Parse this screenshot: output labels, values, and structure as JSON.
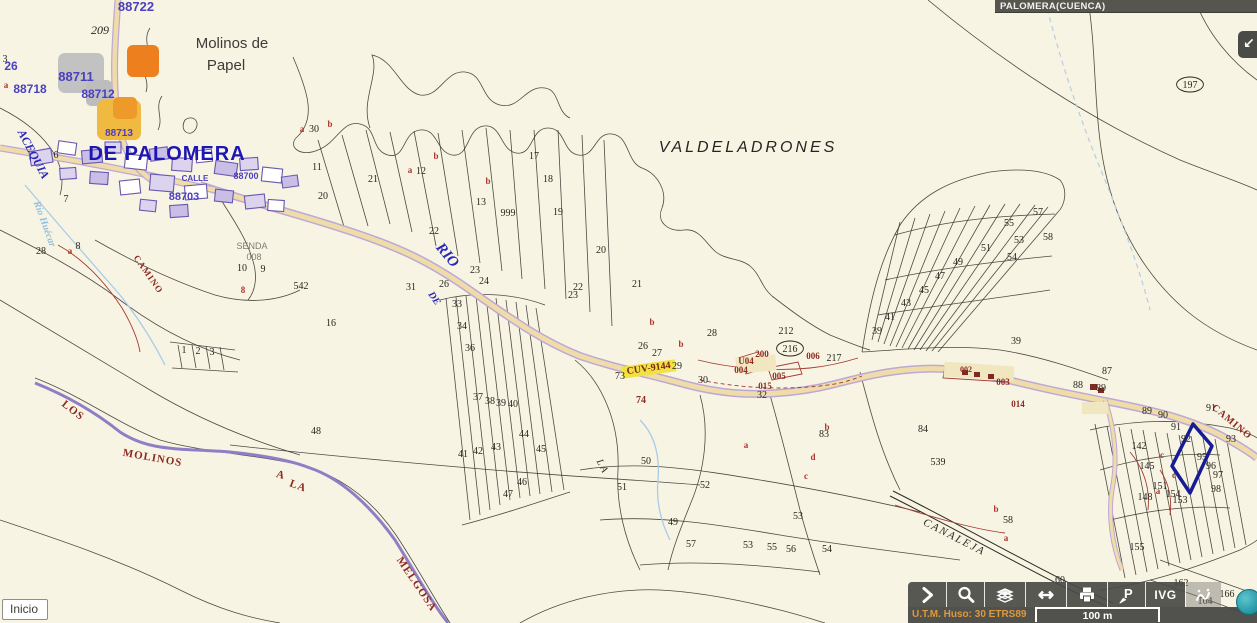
{
  "header": {
    "title": "PALOMERA(CUENCA)"
  },
  "controls": {
    "inicio_label": "Inicio",
    "expand_icon": "collapse-arrow-icon"
  },
  "toolbar": {
    "ivg_label": "IVG",
    "buttons": [
      {
        "id": "expand-tools",
        "icon": "chevron-right-icon"
      },
      {
        "id": "zoom-search",
        "icon": "magnifier-icon"
      },
      {
        "id": "layers",
        "icon": "layers-icon"
      },
      {
        "id": "measure",
        "icon": "double-arrow-icon"
      },
      {
        "id": "print",
        "icon": "printer-icon"
      },
      {
        "id": "point-query",
        "icon": "point-p-icon"
      },
      {
        "id": "ivg",
        "icon": "text-IVG"
      },
      {
        "id": "sketch",
        "icon": "sketch-icon"
      },
      {
        "id": "info",
        "icon": "info-circle-icon"
      }
    ]
  },
  "statusbar": {
    "utm_text": "U.T.M. Huso: 30 ETRS89",
    "scale_label": "100 m"
  },
  "map": {
    "colors": {
      "background": "#F8F4E3",
      "parcel_line": "#3A3831",
      "boundary_purple": "#8F7EC6",
      "road_fill": "#F0DCA8",
      "road_casing": "#BCA9D6",
      "highlight_navy": "#151C96",
      "toolbar_bg": "#4A4A46",
      "utm_orange": "#DE9A3A",
      "header_bg": "#56564E",
      "marker_orange": "#EE7F1F",
      "marker_amber": "#F0B93F",
      "marker_gray": "#C2C2C2",
      "cuv_yellow": "#EFE13A",
      "stream_blue": "#A8CCE8",
      "red_line": "#A43A32"
    },
    "labels": [
      {
        "t": "Molinos de",
        "x": 232,
        "y": 48,
        "k": "place",
        "s": 15
      },
      {
        "t": "Papel",
        "x": 226,
        "y": 70,
        "k": "place",
        "s": 15
      },
      {
        "t": "VALDELADRONES",
        "x": 748,
        "y": 152,
        "k": "valde",
        "s": 16
      },
      {
        "t": "DE PALOMERA",
        "x": 167,
        "y": 160,
        "k": "bluebig",
        "s": 20
      },
      {
        "t": "ACEQUIA",
        "x": 30,
        "y": 156,
        "k": "blueital",
        "s": 12,
        "r": 62
      },
      {
        "t": "Río Huécar",
        "x": 42,
        "y": 225,
        "k": "stream",
        "s": 10,
        "r": 70
      },
      {
        "t": "RIO",
        "x": 444,
        "y": 258,
        "k": "blueital",
        "s": 15,
        "r": 50
      },
      {
        "t": "DE",
        "x": 432,
        "y": 300,
        "k": "blueital",
        "s": 10,
        "r": 55
      },
      {
        "t": "SENDA",
        "x": 252,
        "y": 249,
        "k": "gray",
        "s": 9
      },
      {
        "t": "008",
        "x": 254,
        "y": 260,
        "k": "gray",
        "s": 9
      },
      {
        "t": "LOS",
        "x": 71,
        "y": 413,
        "k": "road",
        "s": 11,
        "r": 38
      },
      {
        "t": "MOLINOS",
        "x": 152,
        "y": 461,
        "k": "road",
        "s": 11,
        "r": 10
      },
      {
        "t": "A",
        "x": 280,
        "y": 478,
        "k": "road",
        "s": 11,
        "r": 15
      },
      {
        "t": "LA",
        "x": 297,
        "y": 489,
        "k": "road",
        "s": 11,
        "r": 20
      },
      {
        "t": "MELGOSA",
        "x": 414,
        "y": 586,
        "k": "road",
        "s": 11,
        "r": 56
      },
      {
        "t": "CANALEJA",
        "x": 953,
        "y": 540,
        "k": "canal",
        "s": 11,
        "r": 27
      },
      {
        "t": "CAMINO",
        "x": 1230,
        "y": 424,
        "k": "road",
        "s": 10,
        "r": 40
      },
      {
        "t": "CAMINO",
        "x": 146,
        "y": 276,
        "k": "road",
        "s": 9,
        "r": 55
      },
      {
        "t": "CUV-9144",
        "x": 649,
        "y": 371,
        "k": "cuv",
        "s": 10,
        "r": -8
      },
      {
        "t": "LA",
        "x": 600,
        "y": 468,
        "k": "canal",
        "s": 10,
        "r": 62
      },
      {
        "t": "88722",
        "x": 136,
        "y": 11,
        "k": "village",
        "s": 13
      },
      {
        "t": "26",
        "x": 11,
        "y": 70,
        "k": "village",
        "s": 12
      },
      {
        "t": "88711",
        "x": 76,
        "y": 81,
        "k": "village",
        "s": 13
      },
      {
        "t": "88718",
        "x": 30,
        "y": 93,
        "k": "village",
        "s": 12
      },
      {
        "t": "88712",
        "x": 98,
        "y": 98,
        "k": "village",
        "s": 12
      },
      {
        "t": "88713",
        "x": 119,
        "y": 136,
        "k": "village",
        "s": 10
      },
      {
        "t": "88703",
        "x": 184,
        "y": 200,
        "k": "village",
        "s": 11
      },
      {
        "t": "CALLE",
        "x": 195,
        "y": 181,
        "k": "village",
        "s": 8
      },
      {
        "t": "88700",
        "x": 246,
        "y": 179,
        "k": "village",
        "s": 9
      },
      {
        "t": "3",
        "x": 5,
        "y": 62,
        "k": "num"
      },
      {
        "t": "a",
        "x": 6,
        "y": 88,
        "k": "red"
      },
      {
        "t": "209",
        "x": 100,
        "y": 34,
        "k": "numi",
        "s": 12
      },
      {
        "t": "216",
        "x": 790,
        "y": 352,
        "k": "num",
        "s": 10,
        "oval": 1
      },
      {
        "t": "197",
        "x": 1190,
        "y": 88,
        "k": "num",
        "s": 10,
        "oval": 1
      },
      {
        "t": "212",
        "x": 786,
        "y": 334,
        "k": "num",
        "s": 9
      },
      {
        "t": "200",
        "x": 762,
        "y": 357,
        "k": "code",
        "s": 9
      },
      {
        "t": "U04",
        "x": 746,
        "y": 364,
        "k": "code",
        "s": 9
      },
      {
        "t": "004",
        "x": 741,
        "y": 373,
        "k": "code",
        "s": 9
      },
      {
        "t": "005",
        "x": 779,
        "y": 379,
        "k": "code",
        "s": 9
      },
      {
        "t": "015",
        "x": 765,
        "y": 389,
        "k": "code",
        "s": 9
      },
      {
        "t": "006",
        "x": 813,
        "y": 359,
        "k": "code",
        "s": 9
      },
      {
        "t": "217",
        "x": 834,
        "y": 361,
        "k": "num",
        "s": 10
      },
      {
        "t": "003",
        "x": 1003,
        "y": 385,
        "k": "code",
        "s": 9
      },
      {
        "t": "014",
        "x": 1018,
        "y": 407,
        "k": "code",
        "s": 9
      },
      {
        "t": "002",
        "x": 966,
        "y": 372,
        "k": "code",
        "s": 8
      },
      {
        "t": "74",
        "x": 641,
        "y": 403,
        "k": "code",
        "s": 10
      },
      {
        "t": "b",
        "x": 330,
        "y": 127,
        "k": "red"
      },
      {
        "t": "b",
        "x": 436,
        "y": 159,
        "k": "red"
      },
      {
        "t": "b",
        "x": 488,
        "y": 184,
        "k": "red"
      },
      {
        "t": "a",
        "x": 410,
        "y": 173,
        "k": "red"
      },
      {
        "t": "a",
        "x": 302,
        "y": 132,
        "k": "red"
      },
      {
        "t": "b",
        "x": 652,
        "y": 325,
        "k": "red"
      },
      {
        "t": "b",
        "x": 681,
        "y": 347,
        "k": "red"
      },
      {
        "t": "a",
        "x": 746,
        "y": 448,
        "k": "red"
      },
      {
        "t": "d",
        "x": 813,
        "y": 460,
        "k": "red"
      },
      {
        "t": "c",
        "x": 806,
        "y": 479,
        "k": "red"
      },
      {
        "t": "b",
        "x": 827,
        "y": 430,
        "k": "red"
      },
      {
        "t": "a",
        "x": 1006,
        "y": 541,
        "k": "red"
      },
      {
        "t": "b",
        "x": 996,
        "y": 512,
        "k": "red"
      },
      {
        "t": "c",
        "x": 1162,
        "y": 458,
        "k": "red"
      },
      {
        "t": "c",
        "x": 1174,
        "y": 478,
        "k": "red"
      },
      {
        "t": "a",
        "x": 1158,
        "y": 494,
        "k": "red"
      },
      {
        "t": "a",
        "x": 70,
        "y": 254,
        "k": "red"
      },
      {
        "t": "8",
        "x": 243,
        "y": 293,
        "k": "red"
      },
      {
        "t": "30",
        "x": 314,
        "y": 132,
        "k": "num"
      },
      {
        "t": "11",
        "x": 317,
        "y": 170,
        "k": "num"
      },
      {
        "t": "20",
        "x": 323,
        "y": 199,
        "k": "num"
      },
      {
        "t": "21",
        "x": 373,
        "y": 182,
        "k": "num"
      },
      {
        "t": "12",
        "x": 421,
        "y": 174,
        "k": "num"
      },
      {
        "t": "13",
        "x": 481,
        "y": 205,
        "k": "num"
      },
      {
        "t": "999",
        "x": 508,
        "y": 216,
        "k": "num"
      },
      {
        "t": "17",
        "x": 534,
        "y": 159,
        "k": "num"
      },
      {
        "t": "18",
        "x": 548,
        "y": 182,
        "k": "num"
      },
      {
        "t": "19",
        "x": 558,
        "y": 215,
        "k": "num"
      },
      {
        "t": "20",
        "x": 601,
        "y": 253,
        "k": "num"
      },
      {
        "t": "21",
        "x": 637,
        "y": 287,
        "k": "num"
      },
      {
        "t": "22",
        "x": 434,
        "y": 234,
        "k": "num",
        "s": 9
      },
      {
        "t": "22",
        "x": 578,
        "y": 290,
        "k": "num",
        "s": 9
      },
      {
        "t": "23",
        "x": 573,
        "y": 298,
        "k": "num",
        "s": 9
      },
      {
        "t": "23",
        "x": 475,
        "y": 273,
        "k": "num",
        "s": 9
      },
      {
        "t": "24",
        "x": 484,
        "y": 284,
        "k": "num",
        "s": 9
      },
      {
        "t": "26",
        "x": 444,
        "y": 287,
        "k": "num",
        "s": 9
      },
      {
        "t": "31",
        "x": 411,
        "y": 290,
        "k": "num"
      },
      {
        "t": "28",
        "x": 712,
        "y": 336,
        "k": "num"
      },
      {
        "t": "6",
        "x": 56,
        "y": 158,
        "k": "num",
        "s": 8
      },
      {
        "t": "7",
        "x": 66,
        "y": 202,
        "k": "num"
      },
      {
        "t": "8",
        "x": 78,
        "y": 249,
        "k": "num"
      },
      {
        "t": "28",
        "x": 41,
        "y": 254,
        "k": "num"
      },
      {
        "t": "10",
        "x": 242,
        "y": 271,
        "k": "num"
      },
      {
        "t": "9",
        "x": 263,
        "y": 272,
        "k": "num"
      },
      {
        "t": "542",
        "x": 301,
        "y": 289,
        "k": "num"
      },
      {
        "t": "16",
        "x": 331,
        "y": 326,
        "k": "num"
      },
      {
        "t": "1",
        "x": 184,
        "y": 353,
        "k": "num",
        "s": 8
      },
      {
        "t": "2",
        "x": 198,
        "y": 354,
        "k": "num",
        "s": 8
      },
      {
        "t": "3",
        "x": 212,
        "y": 355,
        "k": "num",
        "s": 8
      },
      {
        "t": "33",
        "x": 457,
        "y": 307,
        "k": "num"
      },
      {
        "t": "34",
        "x": 462,
        "y": 329,
        "k": "num"
      },
      {
        "t": "36",
        "x": 470,
        "y": 351,
        "k": "num"
      },
      {
        "t": "37",
        "x": 478,
        "y": 400,
        "k": "num",
        "s": 8
      },
      {
        "t": "38",
        "x": 490,
        "y": 404,
        "k": "num",
        "s": 8
      },
      {
        "t": "39",
        "x": 501,
        "y": 406,
        "k": "num",
        "s": 8
      },
      {
        "t": "40",
        "x": 513,
        "y": 407,
        "k": "num",
        "s": 8
      },
      {
        "t": "41",
        "x": 463,
        "y": 457,
        "k": "num"
      },
      {
        "t": "42",
        "x": 478,
        "y": 454,
        "k": "num"
      },
      {
        "t": "43",
        "x": 496,
        "y": 450,
        "k": "num"
      },
      {
        "t": "44",
        "x": 524,
        "y": 437,
        "k": "num"
      },
      {
        "t": "45",
        "x": 541,
        "y": 452,
        "k": "num"
      },
      {
        "t": "46",
        "x": 522,
        "y": 485,
        "k": "num"
      },
      {
        "t": "47",
        "x": 508,
        "y": 497,
        "k": "num"
      },
      {
        "t": "48",
        "x": 316,
        "y": 434,
        "k": "num",
        "s": 11
      },
      {
        "t": "26",
        "x": 643,
        "y": 349,
        "k": "num",
        "s": 9
      },
      {
        "t": "27",
        "x": 657,
        "y": 356,
        "k": "num",
        "s": 9
      },
      {
        "t": "29",
        "x": 677,
        "y": 369,
        "k": "num"
      },
      {
        "t": "73",
        "x": 620,
        "y": 379,
        "k": "num"
      },
      {
        "t": "30",
        "x": 703,
        "y": 383,
        "k": "num"
      },
      {
        "t": "32",
        "x": 762,
        "y": 398,
        "k": "num"
      },
      {
        "t": "39",
        "x": 1016,
        "y": 344,
        "k": "num"
      },
      {
        "t": "50",
        "x": 646,
        "y": 464,
        "k": "num"
      },
      {
        "t": "51",
        "x": 622,
        "y": 490,
        "k": "num"
      },
      {
        "t": "52",
        "x": 705,
        "y": 488,
        "k": "num"
      },
      {
        "t": "49",
        "x": 673,
        "y": 525,
        "k": "num"
      },
      {
        "t": "57",
        "x": 691,
        "y": 547,
        "k": "num"
      },
      {
        "t": "53",
        "x": 748,
        "y": 548,
        "k": "num"
      },
      {
        "t": "55",
        "x": 772,
        "y": 550,
        "k": "num"
      },
      {
        "t": "56",
        "x": 791,
        "y": 552,
        "k": "num"
      },
      {
        "t": "53",
        "x": 798,
        "y": 519,
        "k": "num"
      },
      {
        "t": "54",
        "x": 827,
        "y": 552,
        "k": "num"
      },
      {
        "t": "58",
        "x": 1008,
        "y": 523,
        "k": "num"
      },
      {
        "t": "60",
        "x": 1060,
        "y": 583,
        "k": "num"
      },
      {
        "t": "83",
        "x": 824,
        "y": 437,
        "k": "num"
      },
      {
        "t": "84",
        "x": 923,
        "y": 432,
        "k": "num"
      },
      {
        "t": "539",
        "x": 938,
        "y": 465,
        "k": "num"
      },
      {
        "t": "87",
        "x": 1107,
        "y": 374,
        "k": "num"
      },
      {
        "t": "88",
        "x": 1078,
        "y": 388,
        "k": "num"
      },
      {
        "t": "89",
        "x": 1101,
        "y": 391,
        "k": "num"
      },
      {
        "t": "89",
        "x": 1147,
        "y": 414,
        "k": "num",
        "s": 8
      },
      {
        "t": "90",
        "x": 1163,
        "y": 418,
        "k": "num",
        "s": 8
      },
      {
        "t": "91",
        "x": 1211,
        "y": 411,
        "k": "num"
      },
      {
        "t": "91",
        "x": 1176,
        "y": 430,
        "k": "num"
      },
      {
        "t": "92",
        "x": 1186,
        "y": 442,
        "k": "num"
      },
      {
        "t": "93",
        "x": 1231,
        "y": 442,
        "k": "num"
      },
      {
        "t": "95",
        "x": 1202,
        "y": 460,
        "k": "num"
      },
      {
        "t": "96",
        "x": 1211,
        "y": 469,
        "k": "num"
      },
      {
        "t": "97",
        "x": 1218,
        "y": 478,
        "k": "num"
      },
      {
        "t": "98",
        "x": 1216,
        "y": 492,
        "k": "num"
      },
      {
        "t": "142",
        "x": 1139,
        "y": 449,
        "k": "num"
      },
      {
        "t": "145",
        "x": 1147,
        "y": 469,
        "k": "num"
      },
      {
        "t": "148",
        "x": 1145,
        "y": 500,
        "k": "num"
      },
      {
        "t": "151",
        "x": 1160,
        "y": 489,
        "k": "num"
      },
      {
        "t": "154",
        "x": 1173,
        "y": 497,
        "k": "num"
      },
      {
        "t": "153",
        "x": 1180,
        "y": 503,
        "k": "num"
      },
      {
        "t": "155",
        "x": 1137,
        "y": 550,
        "k": "num"
      },
      {
        "t": "57",
        "x": 1038,
        "y": 215,
        "k": "num"
      },
      {
        "t": "55",
        "x": 1009,
        "y": 226,
        "k": "num"
      },
      {
        "t": "58",
        "x": 1048,
        "y": 240,
        "k": "num"
      },
      {
        "t": "53",
        "x": 1019,
        "y": 243,
        "k": "num"
      },
      {
        "t": "51",
        "x": 986,
        "y": 251,
        "k": "num"
      },
      {
        "t": "54",
        "x": 1012,
        "y": 260,
        "k": "num"
      },
      {
        "t": "49",
        "x": 958,
        "y": 265,
        "k": "num"
      },
      {
        "t": "47",
        "x": 940,
        "y": 279,
        "k": "num"
      },
      {
        "t": "45",
        "x": 924,
        "y": 293,
        "k": "num"
      },
      {
        "t": "43",
        "x": 906,
        "y": 306,
        "k": "num"
      },
      {
        "t": "41",
        "x": 890,
        "y": 320,
        "k": "num"
      },
      {
        "t": "39",
        "x": 877,
        "y": 334,
        "k": "num"
      },
      {
        "t": "162",
        "x": 1181,
        "y": 586,
        "k": "num",
        "s": 8
      },
      {
        "t": "166",
        "x": 1227,
        "y": 597,
        "k": "num",
        "s": 8
      },
      {
        "t": "164",
        "x": 1205,
        "y": 604,
        "k": "num",
        "s": 8
      }
    ]
  }
}
